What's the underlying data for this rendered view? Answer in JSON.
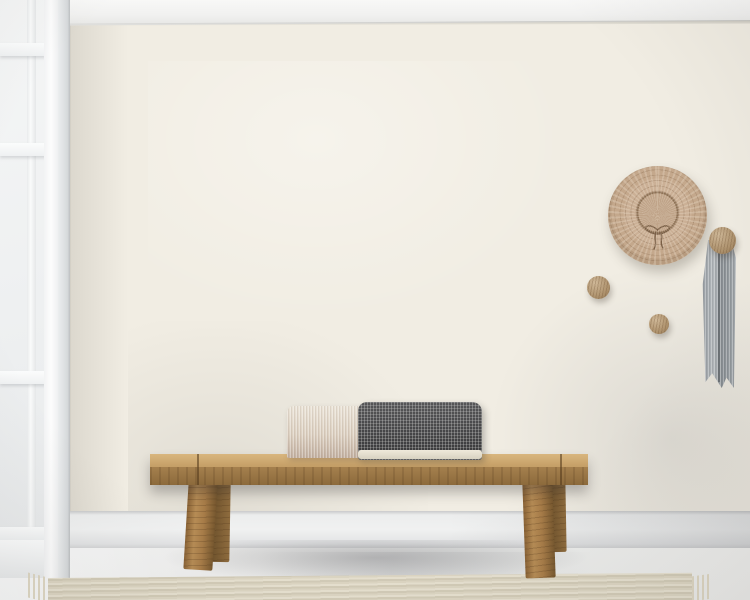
{
  "scene": {
    "type": "interior product mockup photograph",
    "description": "Room with a monochrome city street-map wall mural, a white paned window on the left, a rustic wooden bench with a two-tone lumbar cushion and a fringed cream throw, a straw hat and wooden knobs with a gray linen ribbon hanging on the wall, whitewashed plank flooring and a ribbed woven runner rug"
  },
  "palette": {
    "map_background": "#f1ede3",
    "map_ink": "#2b2b2b",
    "ceiling_white": "#f4f4f3",
    "window_frame": "#fafbfb",
    "baseboard": "#ededee",
    "floor_wash": "#ebecec",
    "plank_gap": "#3d3f40",
    "rug_beige": "#ddd6c3",
    "bench_wood": "#a5804e",
    "blanket_cream": "#e9e2d2",
    "pillow_cream": "#ddd1c2",
    "pillow_charcoal": "#434345",
    "hat_straw": "#c4a88c",
    "knob_wood": "#ad916c",
    "ribbon_gray": "#9aa0a5"
  },
  "map_mural": {
    "style": "black and white city street map, radial ring-road city plan",
    "background": "#f1ede3",
    "ink": "#2b2b2b",
    "center": [
      378,
      326
    ],
    "ring_radii": [
      46,
      92,
      140,
      194,
      254,
      325
    ],
    "radial_count": 14,
    "mesh_step": 15,
    "seed": 20240711,
    "highways": [
      [
        [
          68,
          196
        ],
        [
          150,
          181
        ],
        [
          250,
          163
        ],
        [
          332,
          150
        ],
        [
          420,
          108
        ],
        [
          470,
          86
        ],
        [
          502,
          58
        ],
        [
          512,
          22
        ]
      ],
      [
        [
          68,
          332
        ],
        [
          130,
          360
        ],
        [
          200,
          396
        ],
        [
          262,
          430
        ],
        [
          330,
          470
        ],
        [
          400,
          500
        ],
        [
          442,
          513
        ]
      ],
      [
        [
          442,
          513
        ],
        [
          540,
          480
        ],
        [
          642,
          450
        ],
        [
          750,
          427
        ]
      ],
      [
        [
          520,
          513
        ],
        [
          622,
          494
        ],
        [
          722,
          478
        ],
        [
          750,
          474
        ]
      ],
      [
        [
          415,
          22
        ],
        [
          411,
          120
        ],
        [
          408,
          200
        ],
        [
          416,
          282
        ],
        [
          432,
          362
        ],
        [
          450,
          430
        ],
        [
          461,
          513
        ]
      ],
      [
        [
          590,
          22
        ],
        [
          628,
          92
        ],
        [
          660,
          160
        ],
        [
          700,
          232
        ],
        [
          730,
          300
        ],
        [
          750,
          342
        ]
      ]
    ],
    "railway": [
      [
        80,
        224
      ],
      [
        86,
        282
      ],
      [
        92,
        334
      ],
      [
        96,
        392
      ],
      [
        99,
        452
      ],
      [
        100,
        513
      ]
    ],
    "landmark_blocks": [
      [
        412,
        298
      ],
      [
        428,
        306
      ],
      [
        441,
        300
      ],
      [
        420,
        316
      ],
      [
        436,
        318
      ],
      [
        450,
        310
      ]
    ]
  },
  "decor": {
    "straw_hat": {
      "center": [
        657,
        215
      ],
      "radius": 49,
      "crown_radius": 20,
      "color": "#c4a88c",
      "bow_color": "#7a5f46"
    },
    "knobs": [
      {
        "name": "knob-with-ribbon",
        "center": [
          722,
          240
        ],
        "radius": 13
      },
      {
        "name": "knob-left",
        "center": [
          598,
          287
        ],
        "radius": 11
      },
      {
        "name": "knob-small",
        "center": [
          659,
          324
        ],
        "radius": 10
      }
    ],
    "ribbon": {
      "color": "#9aa0a5",
      "length": 148,
      "hung_from": "knob-with-ribbon"
    }
  },
  "furniture": {
    "bench": {
      "seat_span_x": [
        150,
        588
      ],
      "seat_top_y": 454,
      "wood": "#a5804e",
      "legs": 4
    },
    "pillows": [
      {
        "name": "cream-woven-lumbar",
        "color": "#ddd1c2"
      },
      {
        "name": "charcoal-check-lumbar",
        "color": "#434345",
        "piping": "#e9e3d4"
      }
    ],
    "blanket": {
      "name": "chunky-fringed-throw",
      "color": "#e9e2d2",
      "fringe_base": [
        [
          166,
          482
        ],
        [
          176,
          492
        ],
        [
          188,
          502
        ],
        [
          200,
          513
        ],
        [
          212,
          522
        ],
        [
          224,
          530
        ],
        [
          238,
          537
        ],
        [
          252,
          542
        ],
        [
          266,
          545
        ],
        [
          280,
          546
        ],
        [
          294,
          543
        ],
        [
          308,
          537
        ],
        [
          322,
          528
        ],
        [
          335,
          517
        ],
        [
          347,
          504
        ],
        [
          357,
          490
        ],
        [
          364,
          476
        ],
        [
          369,
          461
        ]
      ]
    },
    "rug": {
      "name": "ribbed-runner",
      "color": "#ddd6c3",
      "span_x": [
        48,
        692
      ]
    }
  },
  "floor": {
    "plank_line_start_x": 86,
    "plank_line_step": 46,
    "plank_line_slant_dx": -74
  }
}
